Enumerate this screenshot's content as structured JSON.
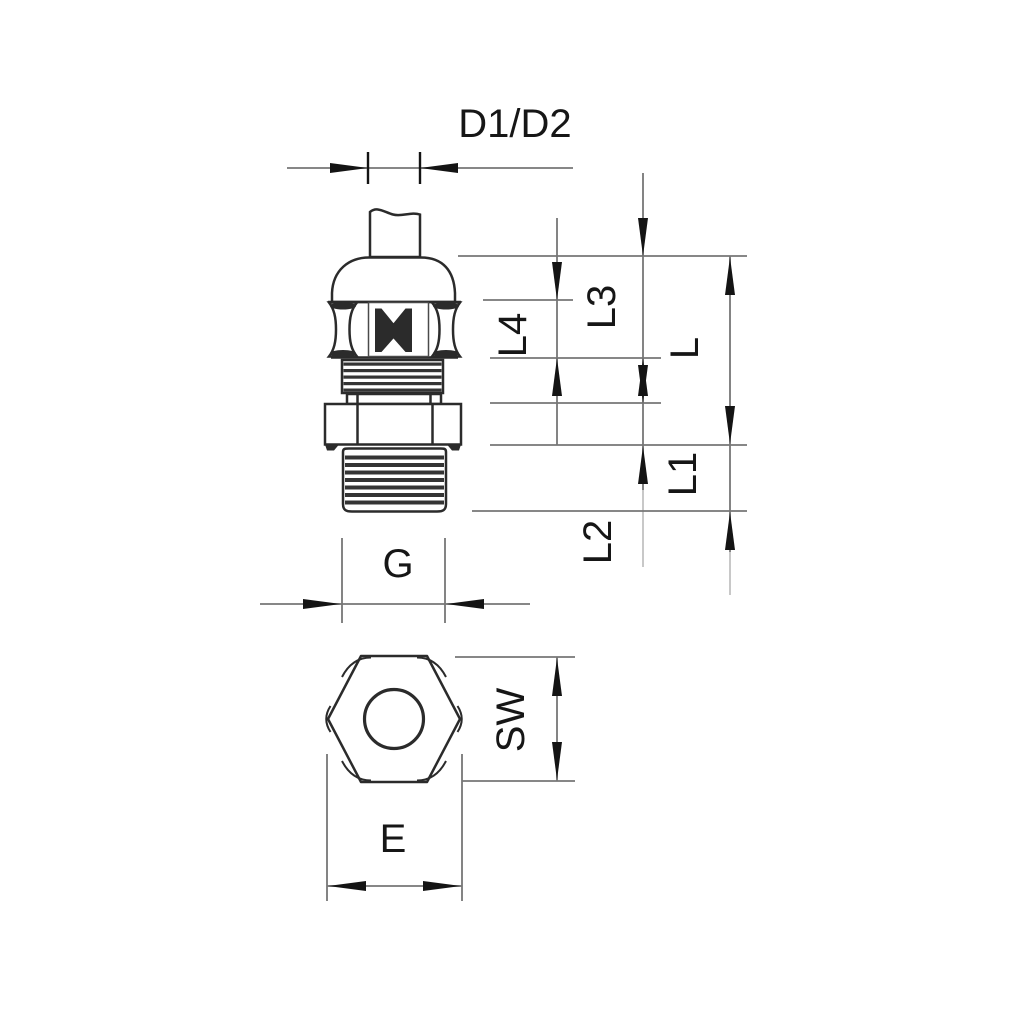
{
  "colors": {
    "bg": "#ffffff",
    "line": "#2b2b2b",
    "dim": "#767676",
    "arrow": "#141414",
    "text": "#161616"
  },
  "labels": {
    "d1d2": "D1/D2",
    "l": "L",
    "l1": "L1",
    "l2": "L2",
    "l3": "L3",
    "l4": "L4",
    "g": "G",
    "sw": "SW",
    "e": "E"
  }
}
